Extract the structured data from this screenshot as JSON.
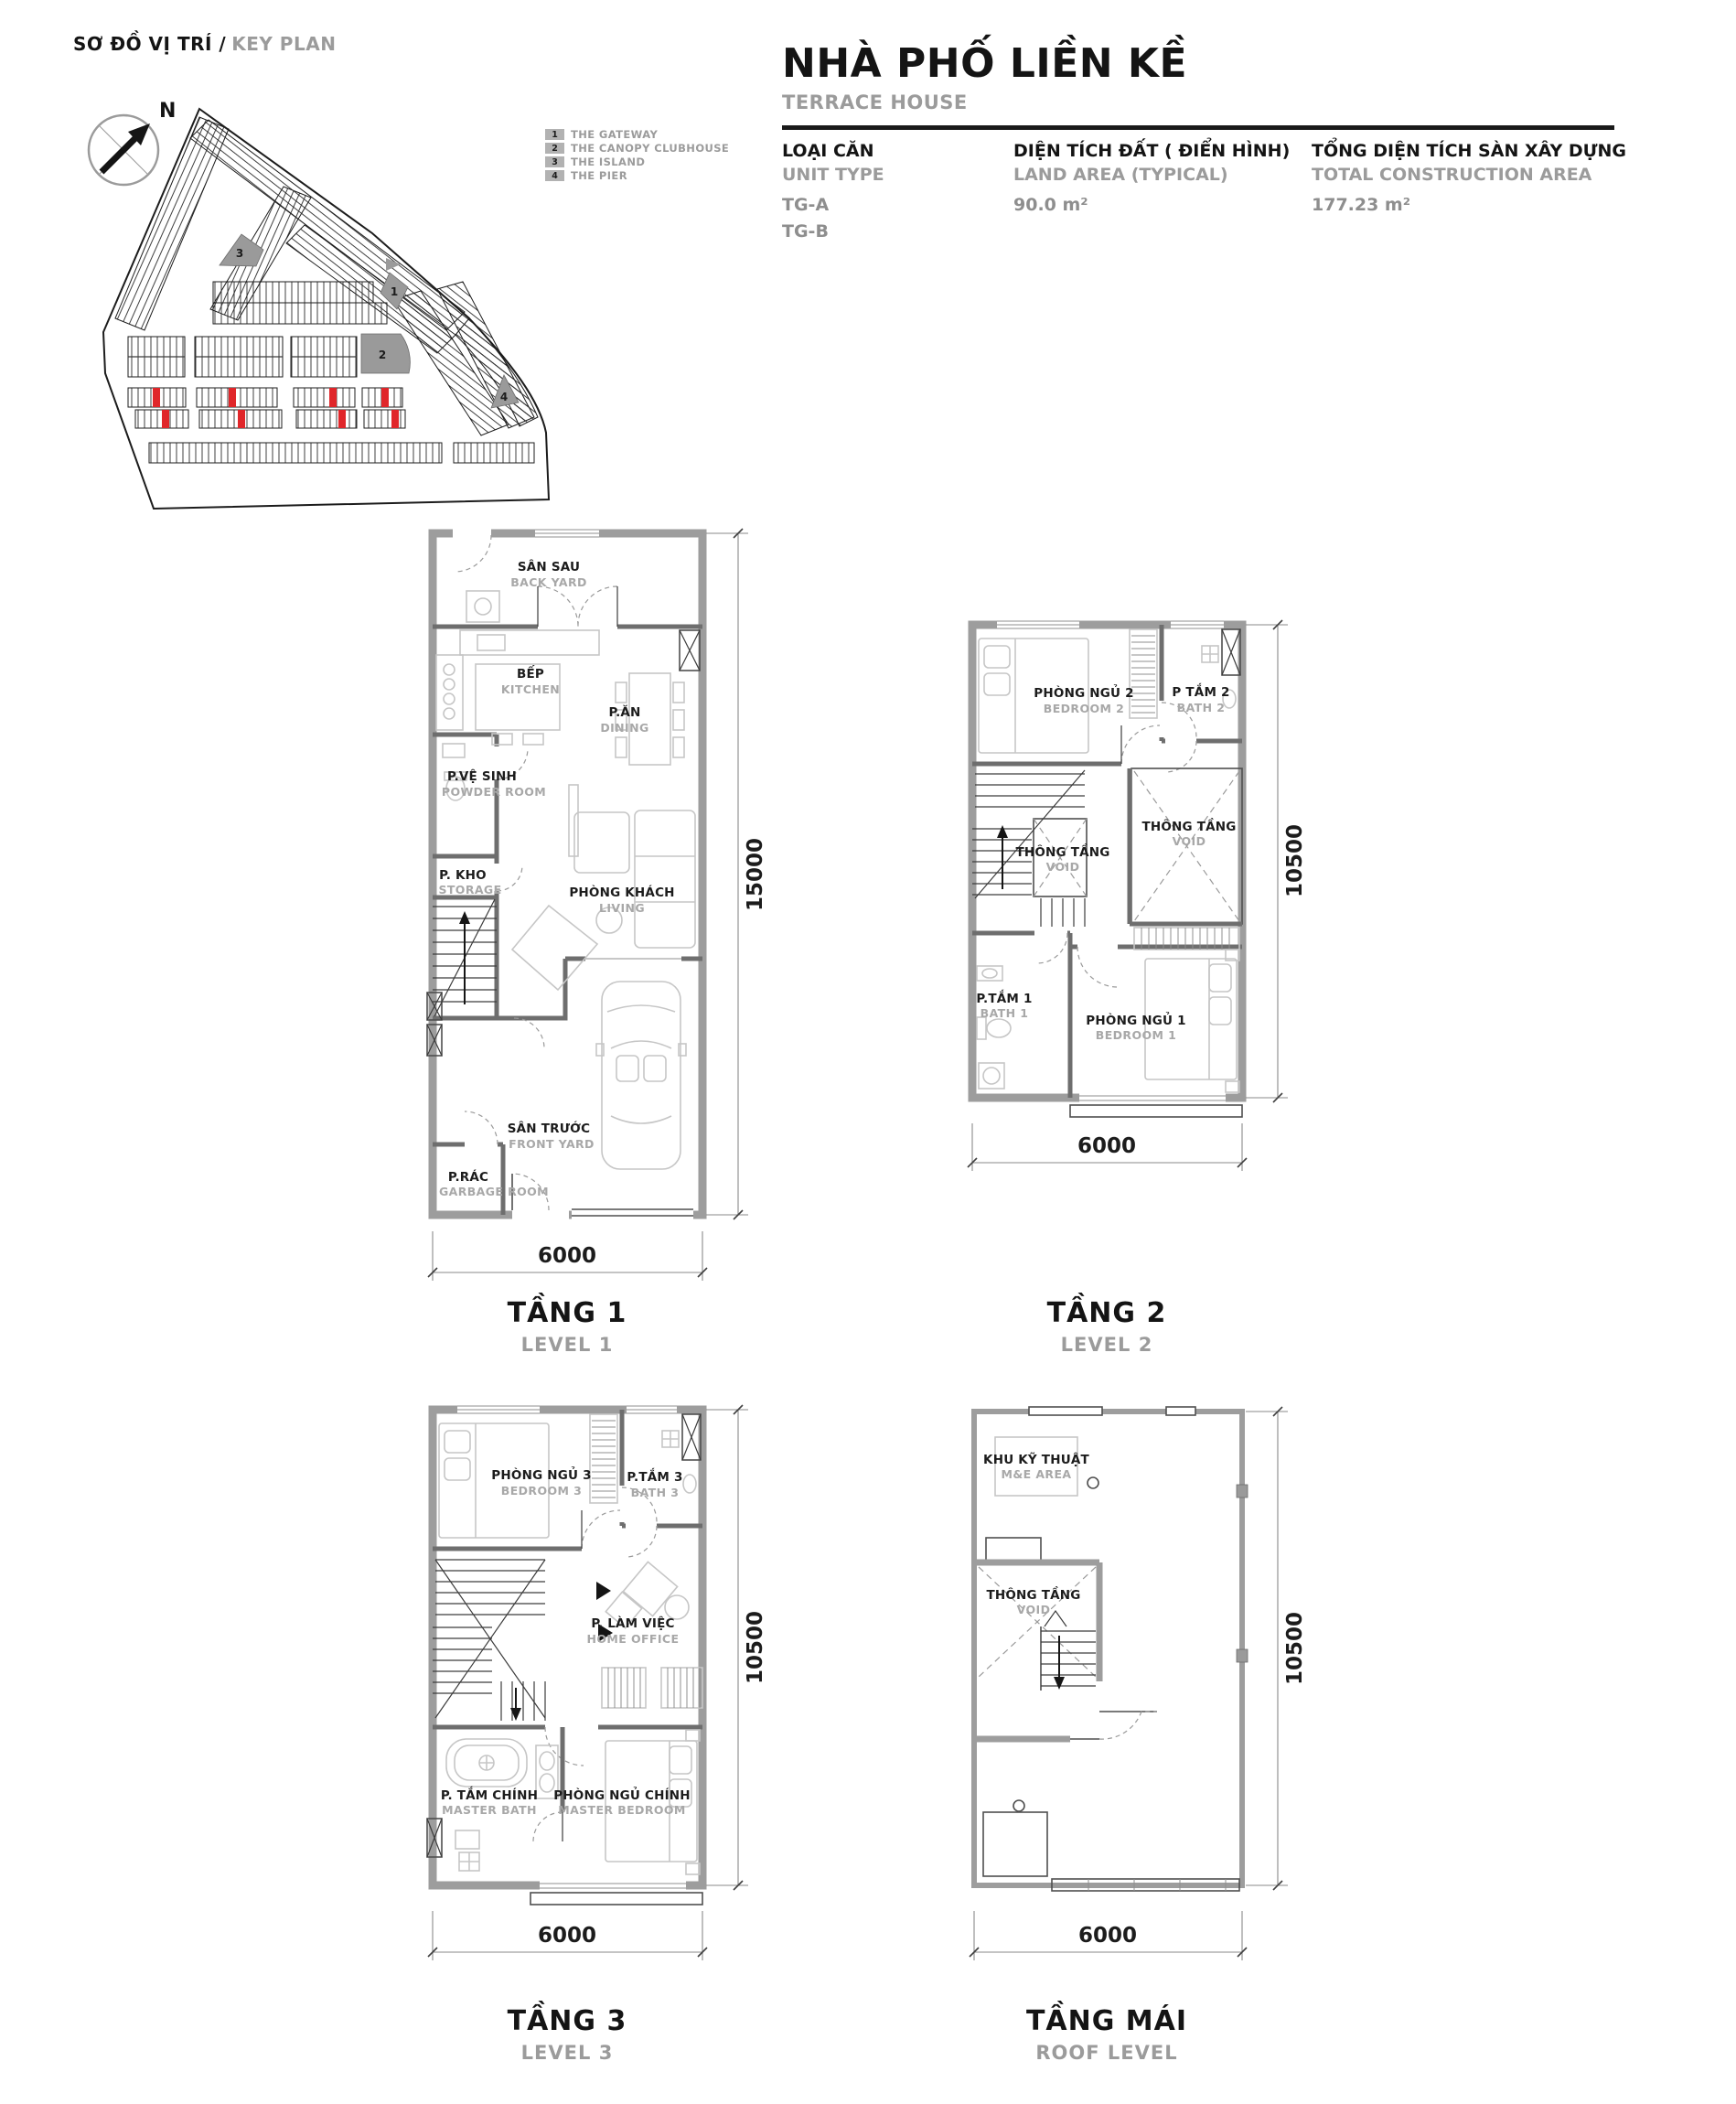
{
  "keyplan": {
    "title_vn": "SƠ ĐỒ VỊ TRÍ /",
    "title_en": "KEY PLAN",
    "north_label": "N",
    "legend": [
      {
        "num": "1",
        "label": "THE GATEWAY"
      },
      {
        "num": "2",
        "label": "THE CANOPY CLUBHOUSE"
      },
      {
        "num": "3",
        "label": "THE ISLAND"
      },
      {
        "num": "4",
        "label": "THE PIER"
      }
    ]
  },
  "header": {
    "title_vn": "NHÀ PHỐ LIỀN KỀ",
    "title_en": "TERRACE HOUSE",
    "columns": [
      {
        "label_vn": "LOẠI CĂN",
        "label_en": "UNIT TYPE",
        "values": [
          "TG-A",
          "TG-B"
        ]
      },
      {
        "label_vn": "DIỆN TÍCH ĐẤT ( ĐIỂN HÌNH)",
        "label_en": "LAND AREA (TYPICAL)",
        "values": [
          "90.0 m²"
        ]
      },
      {
        "label_vn": "TỔNG DIỆN TÍCH SÀN XÂY DỰNG",
        "label_en": "TOTAL CONSTRUCTION AREA",
        "values": [
          "177.23 m²"
        ]
      }
    ]
  },
  "floors": [
    {
      "title_vn": "TẦNG 1",
      "title_en": "LEVEL 1",
      "dim_width": "6000",
      "dim_height": "15000",
      "rooms": [
        {
          "vn": "SÂN SAU",
          "en": "BACK YARD"
        },
        {
          "vn": "BẾP",
          "en": "KITCHEN"
        },
        {
          "vn": "P.ĂN",
          "en": "DINING"
        },
        {
          "vn": "P.VỆ SINH",
          "en": "POWDER ROOM"
        },
        {
          "vn": "P. KHO",
          "en": "STORAGE"
        },
        {
          "vn": "PHÒNG KHÁCH",
          "en": "LIVING"
        },
        {
          "vn": "SÂN TRƯỚC",
          "en": "FRONT YARD"
        },
        {
          "vn": "P.RÁC",
          "en": "GARBAGE ROOM"
        }
      ]
    },
    {
      "title_vn": "TẦNG 2",
      "title_en": "LEVEL 2",
      "dim_width": "6000",
      "dim_height": "10500",
      "rooms": [
        {
          "vn": "PHÒNG NGỦ 2",
          "en": "BEDROOM 2"
        },
        {
          "vn": "P TẮM 2",
          "en": "BATH 2"
        },
        {
          "vn": "THÔNG TẦNG",
          "en": "VOID"
        },
        {
          "vn": "THÔNG TẦNG",
          "en": "VOID"
        },
        {
          "vn": "P.TẮM 1",
          "en": "BATH 1"
        },
        {
          "vn": "PHÒNG NGỦ 1",
          "en": "BEDROOM 1"
        }
      ]
    },
    {
      "title_vn": "TẦNG 3",
      "title_en": "LEVEL 3",
      "dim_width": "6000",
      "dim_height": "10500",
      "rooms": [
        {
          "vn": "PHÒNG NGỦ 3",
          "en": "BEDROOM 3"
        },
        {
          "vn": "P.TẮM 3",
          "en": "BATH 3"
        },
        {
          "vn": "P. LÀM VIỆC",
          "en": "HOME OFFICE"
        },
        {
          "vn": "P. TẮM CHÍNH",
          "en": "MASTER BATH"
        },
        {
          "vn": "PHÒNG NGỦ CHÍNH",
          "en": "MASTER BEDROOM"
        }
      ]
    },
    {
      "title_vn": "TẦNG MÁI",
      "title_en": "ROOF LEVEL",
      "dim_width": "6000",
      "dim_height": "10500",
      "rooms": [
        {
          "vn": "KHU KỸ THUẬT",
          "en": "M&E AREA"
        },
        {
          "vn": "THÔNG TẦNG",
          "en": "VOID"
        }
      ]
    }
  ],
  "colors": {
    "wall_gray": "#9d9d9d",
    "highlight_red": "#e0262a",
    "text_dark": "#1c1c1c",
    "text_gray": "#9b9b9b"
  }
}
